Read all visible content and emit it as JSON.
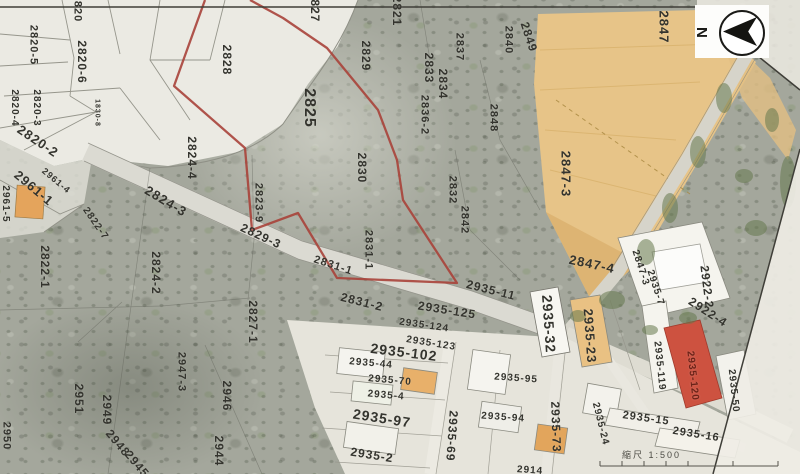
{
  "map": {
    "north_label": "N",
    "scale_label": "縮尺 1:500",
    "highlight_color": "#a8423a",
    "red_parcel_color": "#cd5240",
    "field_color": "#e7c488",
    "labels": [
      {
        "text": "2820",
        "x": 77,
        "y": 8,
        "rot": 90,
        "size": 11
      },
      {
        "text": "2820-5",
        "x": 33,
        "y": 45,
        "rot": 90,
        "size": 11
      },
      {
        "text": "2820-6",
        "x": 82,
        "y": 62,
        "rot": 90,
        "size": 12
      },
      {
        "text": "2820-4",
        "x": 14,
        "y": 108,
        "rot": 90,
        "size": 10
      },
      {
        "text": "2820-3",
        "x": 36,
        "y": 108,
        "rot": 90,
        "size": 10
      },
      {
        "text": "2820-2",
        "x": 38,
        "y": 141,
        "rot": 34,
        "size": 13,
        "bold": true
      },
      {
        "text": "1830-8",
        "x": 97,
        "y": 113,
        "rot": 90,
        "size": 7
      },
      {
        "text": "2961-1",
        "x": 34,
        "y": 188,
        "rot": 40,
        "size": 13,
        "bold": true
      },
      {
        "text": "2961-4",
        "x": 56,
        "y": 181,
        "rot": 40,
        "size": 9
      },
      {
        "text": "2961-5",
        "x": 5,
        "y": 204,
        "rot": 90,
        "size": 10
      },
      {
        "text": "2822-7",
        "x": 95,
        "y": 224,
        "rot": 55,
        "size": 10
      },
      {
        "text": "2822-1",
        "x": 45,
        "y": 267,
        "rot": 90,
        "size": 12
      },
      {
        "text": "2824-2",
        "x": 156,
        "y": 273,
        "rot": 90,
        "size": 12
      },
      {
        "text": "2824-4",
        "x": 192,
        "y": 158,
        "rot": 90,
        "size": 12
      },
      {
        "text": "2824-3",
        "x": 166,
        "y": 201,
        "rot": 31,
        "size": 13
      },
      {
        "text": "2829-3",
        "x": 261,
        "y": 236,
        "rot": 25,
        "size": 12
      },
      {
        "text": "2823-9",
        "x": 258,
        "y": 203,
        "rot": 90,
        "size": 11
      },
      {
        "text": "2827-1",
        "x": 253,
        "y": 322,
        "rot": 90,
        "size": 12
      },
      {
        "text": "2951",
        "x": 79,
        "y": 399,
        "rot": 90,
        "size": 12
      },
      {
        "text": "2949",
        "x": 107,
        "y": 410,
        "rot": 90,
        "size": 12
      },
      {
        "text": "2948",
        "x": 118,
        "y": 443,
        "rot": 50,
        "size": 12
      },
      {
        "text": "2945",
        "x": 137,
        "y": 464,
        "rot": 50,
        "size": 12
      },
      {
        "text": "2944",
        "x": 219,
        "y": 451,
        "rot": 90,
        "size": 12
      },
      {
        "text": "2946",
        "x": 227,
        "y": 396,
        "rot": 90,
        "size": 12
      },
      {
        "text": "2947-3",
        "x": 181,
        "y": 372,
        "rot": 90,
        "size": 11
      },
      {
        "text": "2950",
        "x": 6,
        "y": 436,
        "rot": 90,
        "size": 11
      },
      {
        "text": "2825",
        "x": 309,
        "y": 108,
        "rot": 90,
        "size": 16,
        "bold": true
      },
      {
        "text": "2828",
        "x": 227,
        "y": 60,
        "rot": 90,
        "size": 12
      },
      {
        "text": "2829",
        "x": 366,
        "y": 56,
        "rot": 90,
        "size": 12
      },
      {
        "text": "2830",
        "x": 362,
        "y": 168,
        "rot": 90,
        "size": 12
      },
      {
        "text": "2831-1",
        "x": 368,
        "y": 250,
        "rot": 90,
        "size": 11
      },
      {
        "text": "2831-1",
        "x": 333,
        "y": 266,
        "rot": 18,
        "size": 11
      },
      {
        "text": "2831-2",
        "x": 362,
        "y": 302,
        "rot": 14,
        "size": 12
      },
      {
        "text": "2832",
        "x": 452,
        "y": 190,
        "rot": 90,
        "size": 11
      },
      {
        "text": "2842",
        "x": 464,
        "y": 220,
        "rot": 90,
        "size": 11
      },
      {
        "text": "2833",
        "x": 429,
        "y": 68,
        "rot": 90,
        "size": 12
      },
      {
        "text": "2834",
        "x": 443,
        "y": 84,
        "rot": 90,
        "size": 12
      },
      {
        "text": "2837",
        "x": 459,
        "y": 47,
        "rot": 90,
        "size": 11
      },
      {
        "text": "2840",
        "x": 508,
        "y": 40,
        "rot": 90,
        "size": 11
      },
      {
        "text": "2849",
        "x": 529,
        "y": 37,
        "rot": 72,
        "size": 12
      },
      {
        "text": "2836-2",
        "x": 424,
        "y": 115,
        "rot": 90,
        "size": 11
      },
      {
        "text": "2848",
        "x": 493,
        "y": 118,
        "rot": 90,
        "size": 11
      },
      {
        "text": "2827",
        "x": 315,
        "y": 7,
        "rot": 90,
        "size": 12
      },
      {
        "text": "2821",
        "x": 397,
        "y": 11,
        "rot": 90,
        "size": 12
      },
      {
        "text": "2847",
        "x": 664,
        "y": 27,
        "rot": 90,
        "size": 13
      },
      {
        "text": "2847-3",
        "x": 566,
        "y": 174,
        "rot": 90,
        "size": 13
      },
      {
        "text": "2847-4",
        "x": 592,
        "y": 264,
        "rot": 12,
        "size": 13
      },
      {
        "text": "2847-3",
        "x": 640,
        "y": 268,
        "rot": 72,
        "size": 10
      },
      {
        "text": "2935-7",
        "x": 655,
        "y": 288,
        "rot": 72,
        "size": 10
      },
      {
        "text": "2922-2",
        "x": 707,
        "y": 287,
        "rot": 83,
        "size": 12
      },
      {
        "text": "2922-4",
        "x": 708,
        "y": 312,
        "rot": 33,
        "size": 12
      },
      {
        "text": "2935-11",
        "x": 491,
        "y": 290,
        "rot": 14,
        "size": 12
      },
      {
        "text": "2935-125",
        "x": 447,
        "y": 310,
        "rot": 9,
        "size": 12
      },
      {
        "text": "2935-124",
        "x": 424,
        "y": 326,
        "rot": 8,
        "size": 10
      },
      {
        "text": "2935-123",
        "x": 431,
        "y": 344,
        "rot": 9,
        "size": 10
      },
      {
        "text": "2935-102",
        "x": 404,
        "y": 352,
        "rot": 7,
        "size": 14,
        "bold": true
      },
      {
        "text": "2935-44",
        "x": 371,
        "y": 364,
        "rot": 5,
        "size": 10
      },
      {
        "text": "2935-70",
        "x": 390,
        "y": 381,
        "rot": 5,
        "size": 10
      },
      {
        "text": "2935-4",
        "x": 386,
        "y": 396,
        "rot": 5,
        "size": 10
      },
      {
        "text": "2935-97",
        "x": 382,
        "y": 418,
        "rot": 9,
        "size": 14,
        "bold": true
      },
      {
        "text": "2935-2",
        "x": 372,
        "y": 455,
        "rot": 9,
        "size": 12
      },
      {
        "text": "2935-69",
        "x": 452,
        "y": 436,
        "rot": 94,
        "size": 12
      },
      {
        "text": "2935-95",
        "x": 516,
        "y": 379,
        "rot": 4,
        "size": 10
      },
      {
        "text": "2935-94",
        "x": 503,
        "y": 418,
        "rot": 4,
        "size": 10
      },
      {
        "text": "2935-73",
        "x": 556,
        "y": 427,
        "rot": 88,
        "size": 12
      },
      {
        "text": "2935-24",
        "x": 600,
        "y": 424,
        "rot": 76,
        "size": 10
      },
      {
        "text": "2935-32",
        "x": 549,
        "y": 324,
        "rot": 86,
        "size": 14,
        "bold": true
      },
      {
        "text": "2935-23",
        "x": 590,
        "y": 336,
        "rot": 86,
        "size": 13
      },
      {
        "text": "2935-119",
        "x": 659,
        "y": 366,
        "rot": 84,
        "size": 10
      },
      {
        "text": "2935-120",
        "x": 692,
        "y": 376,
        "rot": 84,
        "size": 10,
        "color": "#6b2318"
      },
      {
        "text": "2935-50",
        "x": 733,
        "y": 391,
        "rot": 84,
        "size": 10
      },
      {
        "text": "2935-15",
        "x": 646,
        "y": 419,
        "rot": 8,
        "size": 11
      },
      {
        "text": "2935-16",
        "x": 696,
        "y": 435,
        "rot": 9,
        "size": 11
      },
      {
        "text": "2914",
        "x": 530,
        "y": 471,
        "rot": 4,
        "size": 10
      }
    ]
  }
}
